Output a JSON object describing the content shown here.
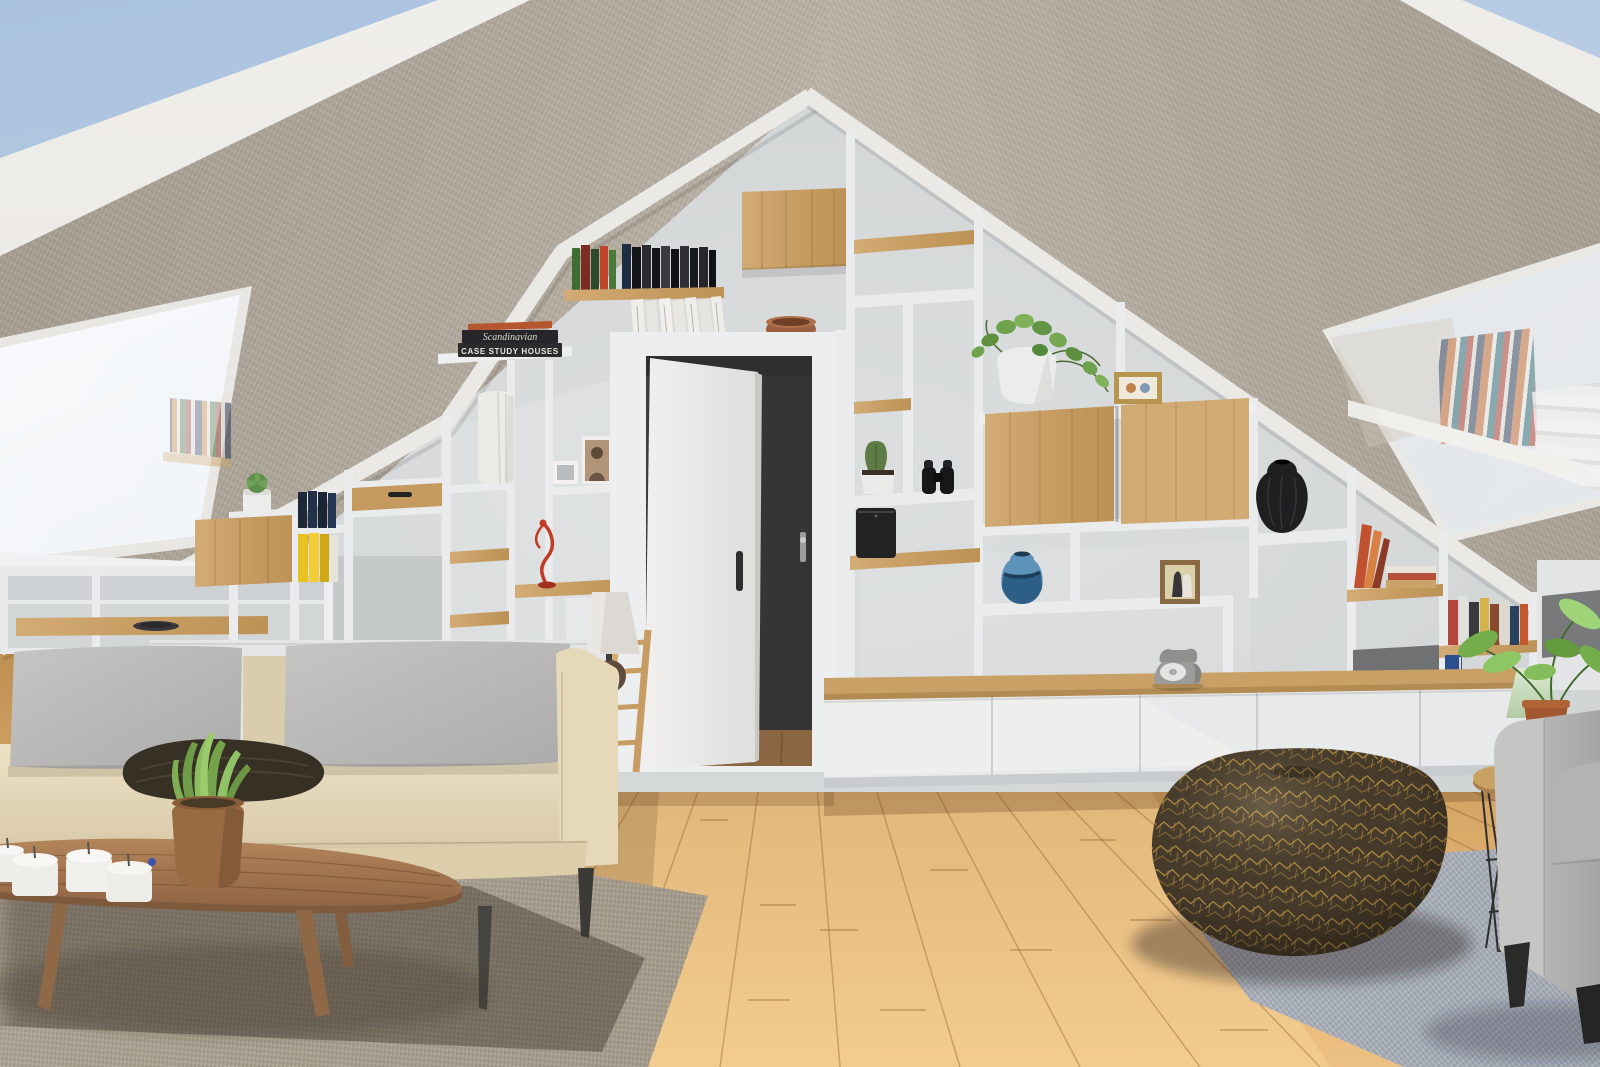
{
  "scene": {
    "title": "Attic living room — 3D interior render",
    "description": "Sunlit attic lounge with A-frame sloped fabric-textured ceilings, a gable wall of built-in white shelving with oak accents, an open white door to a dark hallway, two skylights with bookshelf reflections, a cream sofa with gray cushions, a walnut coffee table with tealight candles and a snake plant, a bronze geometric-patterned pouf on a blue-gray rug, and a gray armchair with a wire side table.",
    "book_spines": {
      "top": "Scandinavian",
      "bottom": "CASE STUDY HOUSES"
    },
    "palette": {
      "sky": "#b3c8e2",
      "ceiling_fabric": "#b9b0a4",
      "ridge_fascia": "#ebe9e5",
      "gable_wall": "#d3d6d7",
      "shelf_white": "#e9ebec",
      "oak_wood": "#cba266",
      "hallway_dark": "#3b3d3c",
      "floor_pine": "#ddab69",
      "rug_left": "#a79e8d",
      "rug_right": "#b7bdc6",
      "sofa_cream": "#e6d9ba",
      "cushion_gray": "#b7b6b4",
      "throw_brown": "#373024",
      "walnut_table": "#a0744f",
      "pouf_bronze": "#46392a",
      "pouf_gold": "#b9913f",
      "armchair_gray": "#b4b4b2",
      "plant_green": "#79a94f",
      "accent_yellow": "#e6bd20",
      "vase_blue": "#4f87b2",
      "vase_black": "#202022",
      "figurine_red": "#c0392b",
      "pot_terracotta": "#9a6540"
    },
    "objects": [
      "left-skylight",
      "right-skylight",
      "gable-shelving-wall",
      "open-door",
      "hallway",
      "oak-cabinet-doors",
      "book-stack-scandinavian",
      "green-books",
      "white-paperbacks",
      "terracotta-bowl",
      "succulent-pot",
      "navy-books",
      "yellow-books",
      "marble-vase",
      "photo-frames",
      "dancer-figurine",
      "table-lamp",
      "pothos-plant",
      "cactus",
      "binoculars",
      "speaker",
      "blue-vase",
      "black-vase",
      "wedding-photo",
      "orange-books",
      "rotary-telephone",
      "lower-cabinets",
      "cream-sofa",
      "gray-back-cushions",
      "brown-throw",
      "walnut-coffee-table",
      "tealight-candles",
      "snake-plant",
      "floor-lamp",
      "wood-ladder",
      "left-rug",
      "right-rug",
      "bronze-pouf",
      "gray-armchair",
      "wire-side-table",
      "green-reading-lamp",
      "potted-plant"
    ]
  }
}
